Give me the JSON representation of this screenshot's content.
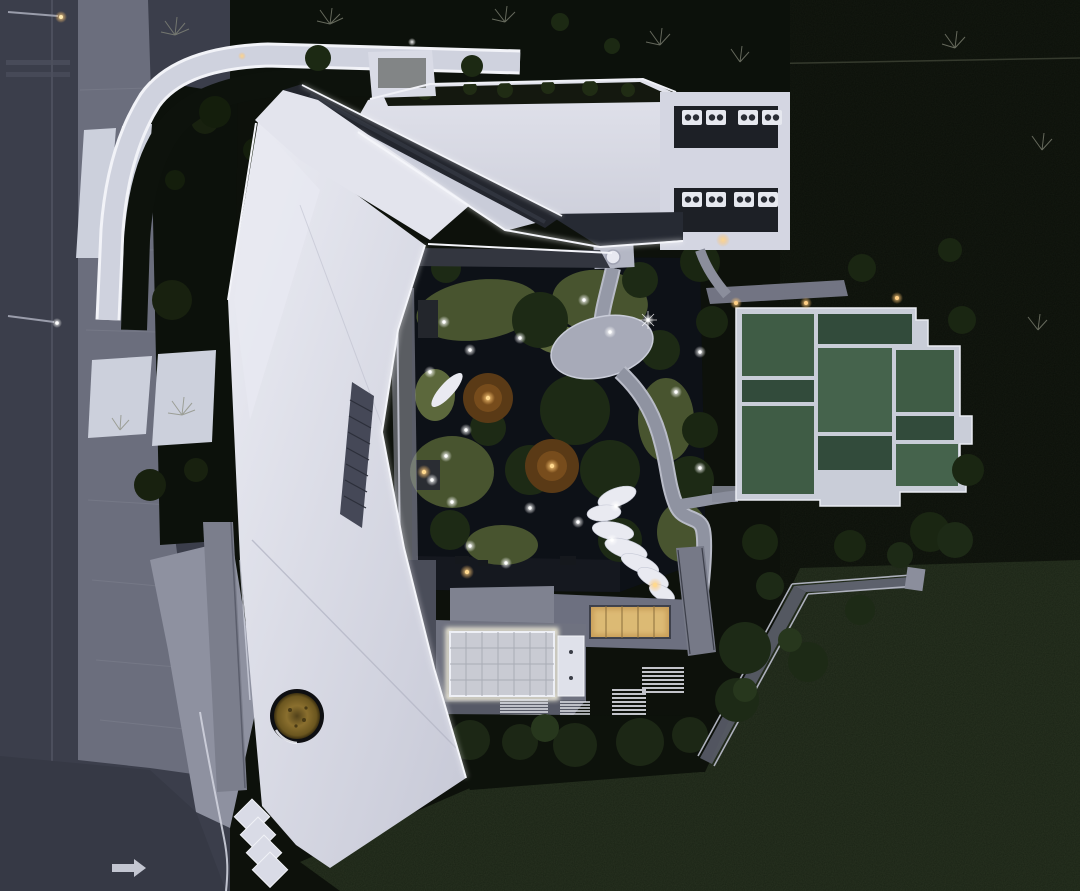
{
  "scene": {
    "type": "aerial-photograph",
    "time_of_day": "dusk",
    "camera": "top-down drone view",
    "subject": "Angular white folded-plate roof building with illuminated edges, central dark courtyard garden with pond and winding path, white-framed green court platform, perimeter road and large dark lawns"
  },
  "palette": {
    "road": "#3b3e4b",
    "roadDark": "#363945",
    "sidewalk": "#6b6e7d",
    "plaza": "#8e91a0",
    "paving": "#ccd0dc",
    "hedge": "#0c110b",
    "vegDark": "#0d110b",
    "lawn": "#1a2315",
    "roofWhite": "#dcdde8",
    "roofBright": "#ecedf4",
    "roofMid": "#c9ccd9",
    "roofShadow": "#aeb0c0",
    "glass": "#23262e",
    "led": "#f4f5fa",
    "pond": "#0d1117",
    "moss": "#48542f",
    "mossLight": "#5c683c",
    "treeDark": "#1d2a15",
    "pathGray": "#9599a7",
    "terrace": "#6f7280",
    "terraceDark": "#565966",
    "court": "#3f5c45",
    "courtDark": "#324b3b",
    "courtLight": "#45634c",
    "courtFrame": "#c9cdd8",
    "stone": "#e9eaf1",
    "warm": "#e9b763",
    "warmGlow": "#f6e3a6",
    "amber": "#8a6f2e",
    "railing": "#aeb1bd"
  },
  "features": {
    "road": {
      "lamps": 2,
      "lane_line": true,
      "arrow_marking": "right-arrow",
      "faint_cross_bands": 2
    },
    "walkway": {
      "type": "curved illuminated white path around north-west corner"
    },
    "building": {
      "roof": "folded white plates with LED-lit edges and diagonal glass skylight strip",
      "oculus_tree": true,
      "serrated_edge_teeth": 4,
      "hvac_rows": 2,
      "hvac_units": [
        {
          "x": 682,
          "y": 110
        },
        {
          "x": 706,
          "y": 110
        },
        {
          "x": 738,
          "y": 110
        },
        {
          "x": 762,
          "y": 110
        },
        {
          "x": 682,
          "y": 192
        },
        {
          "x": 706,
          "y": 192
        },
        {
          "x": 734,
          "y": 192
        },
        {
          "x": 758,
          "y": 192
        }
      ]
    },
    "garden": {
      "pond": true,
      "moss_islands": 6,
      "amber_uplit_trees": 2,
      "boat_sculpture": true,
      "oval_stone_platform": true,
      "canopy_with_column": true,
      "stepping_stones": [
        {
          "x": 617,
          "y": 497,
          "rx": 20,
          "ry": 9,
          "rot": -20
        },
        {
          "x": 604,
          "y": 513,
          "rx": 17,
          "ry": 8,
          "rot": -5
        },
        {
          "x": 613,
          "y": 531,
          "rx": 21,
          "ry": 9,
          "rot": 10
        },
        {
          "x": 626,
          "y": 549,
          "rx": 22,
          "ry": 9,
          "rot": 18
        },
        {
          "x": 640,
          "y": 564,
          "rx": 20,
          "ry": 8,
          "rot": 22
        },
        {
          "x": 653,
          "y": 578,
          "rx": 17,
          "ry": 8,
          "rot": 28
        },
        {
          "x": 662,
          "y": 593,
          "rx": 14,
          "ry": 7,
          "rot": 30
        },
        {
          "x": 669,
          "y": 607,
          "rx": 11,
          "ry": 6,
          "rot": 32
        },
        {
          "x": 674,
          "y": 619,
          "rx": 8,
          "ry": 5,
          "rot": 0
        }
      ],
      "lights": [
        {
          "x": 648,
          "y": 320,
          "kind": "star"
        },
        {
          "x": 444,
          "y": 322,
          "kind": "white"
        },
        {
          "x": 470,
          "y": 350,
          "kind": "white"
        },
        {
          "x": 430,
          "y": 372,
          "kind": "white"
        },
        {
          "x": 520,
          "y": 338,
          "kind": "white"
        },
        {
          "x": 584,
          "y": 300,
          "kind": "white"
        },
        {
          "x": 610,
          "y": 332,
          "kind": "white"
        },
        {
          "x": 676,
          "y": 392,
          "kind": "white"
        },
        {
          "x": 700,
          "y": 352,
          "kind": "white"
        },
        {
          "x": 466,
          "y": 430,
          "kind": "white"
        },
        {
          "x": 446,
          "y": 456,
          "kind": "white"
        },
        {
          "x": 432,
          "y": 480,
          "kind": "white"
        },
        {
          "x": 452,
          "y": 502,
          "kind": "white"
        },
        {
          "x": 530,
          "y": 508,
          "kind": "white"
        },
        {
          "x": 578,
          "y": 522,
          "kind": "white"
        },
        {
          "x": 616,
          "y": 506,
          "kind": "white"
        },
        {
          "x": 688,
          "y": 556,
          "kind": "white"
        },
        {
          "x": 470,
          "y": 546,
          "kind": "white"
        },
        {
          "x": 506,
          "y": 563,
          "kind": "white"
        },
        {
          "x": 700,
          "y": 468,
          "kind": "white"
        },
        {
          "x": 612,
          "y": 540,
          "kind": "white"
        },
        {
          "x": 655,
          "y": 585,
          "kind": "warm"
        },
        {
          "x": 424,
          "y": 472,
          "kind": "warm"
        },
        {
          "x": 467,
          "y": 572,
          "kind": "warm"
        },
        {
          "x": 723,
          "y": 240,
          "kind": "warm"
        },
        {
          "x": 488,
          "y": 398,
          "kind": "warm"
        },
        {
          "x": 552,
          "y": 466,
          "kind": "warm"
        }
      ]
    },
    "courts": {
      "warm_lights": [
        {
          "x": 736,
          "y": 303
        },
        {
          "x": 806,
          "y": 303
        },
        {
          "x": 897,
          "y": 298
        }
      ],
      "panels": [
        {
          "x": 742,
          "y": 314,
          "w": 72,
          "h": 62,
          "tone": "court"
        },
        {
          "x": 818,
          "y": 314,
          "w": 94,
          "h": 30,
          "tone": "courtDark"
        },
        {
          "x": 742,
          "y": 380,
          "w": 72,
          "h": 22,
          "tone": "courtDark"
        },
        {
          "x": 818,
          "y": 348,
          "w": 74,
          "h": 84,
          "tone": "courtLight"
        },
        {
          "x": 896,
          "y": 350,
          "w": 58,
          "h": 62,
          "tone": "court"
        },
        {
          "x": 896,
          "y": 416,
          "w": 58,
          "h": 24,
          "tone": "courtDark"
        },
        {
          "x": 742,
          "y": 406,
          "w": 72,
          "h": 88,
          "tone": "court"
        },
        {
          "x": 818,
          "y": 436,
          "w": 74,
          "h": 34,
          "tone": "courtDark"
        },
        {
          "x": 896,
          "y": 444,
          "w": 62,
          "h": 42,
          "tone": "courtLight"
        }
      ]
    },
    "terrace": {
      "glowing_skylight_grid": true,
      "warm_glass_skylight": true,
      "white_service_panel": true,
      "stair_runs": 4
    },
    "ramp": {
      "switchback_with_railings": true
    }
  }
}
